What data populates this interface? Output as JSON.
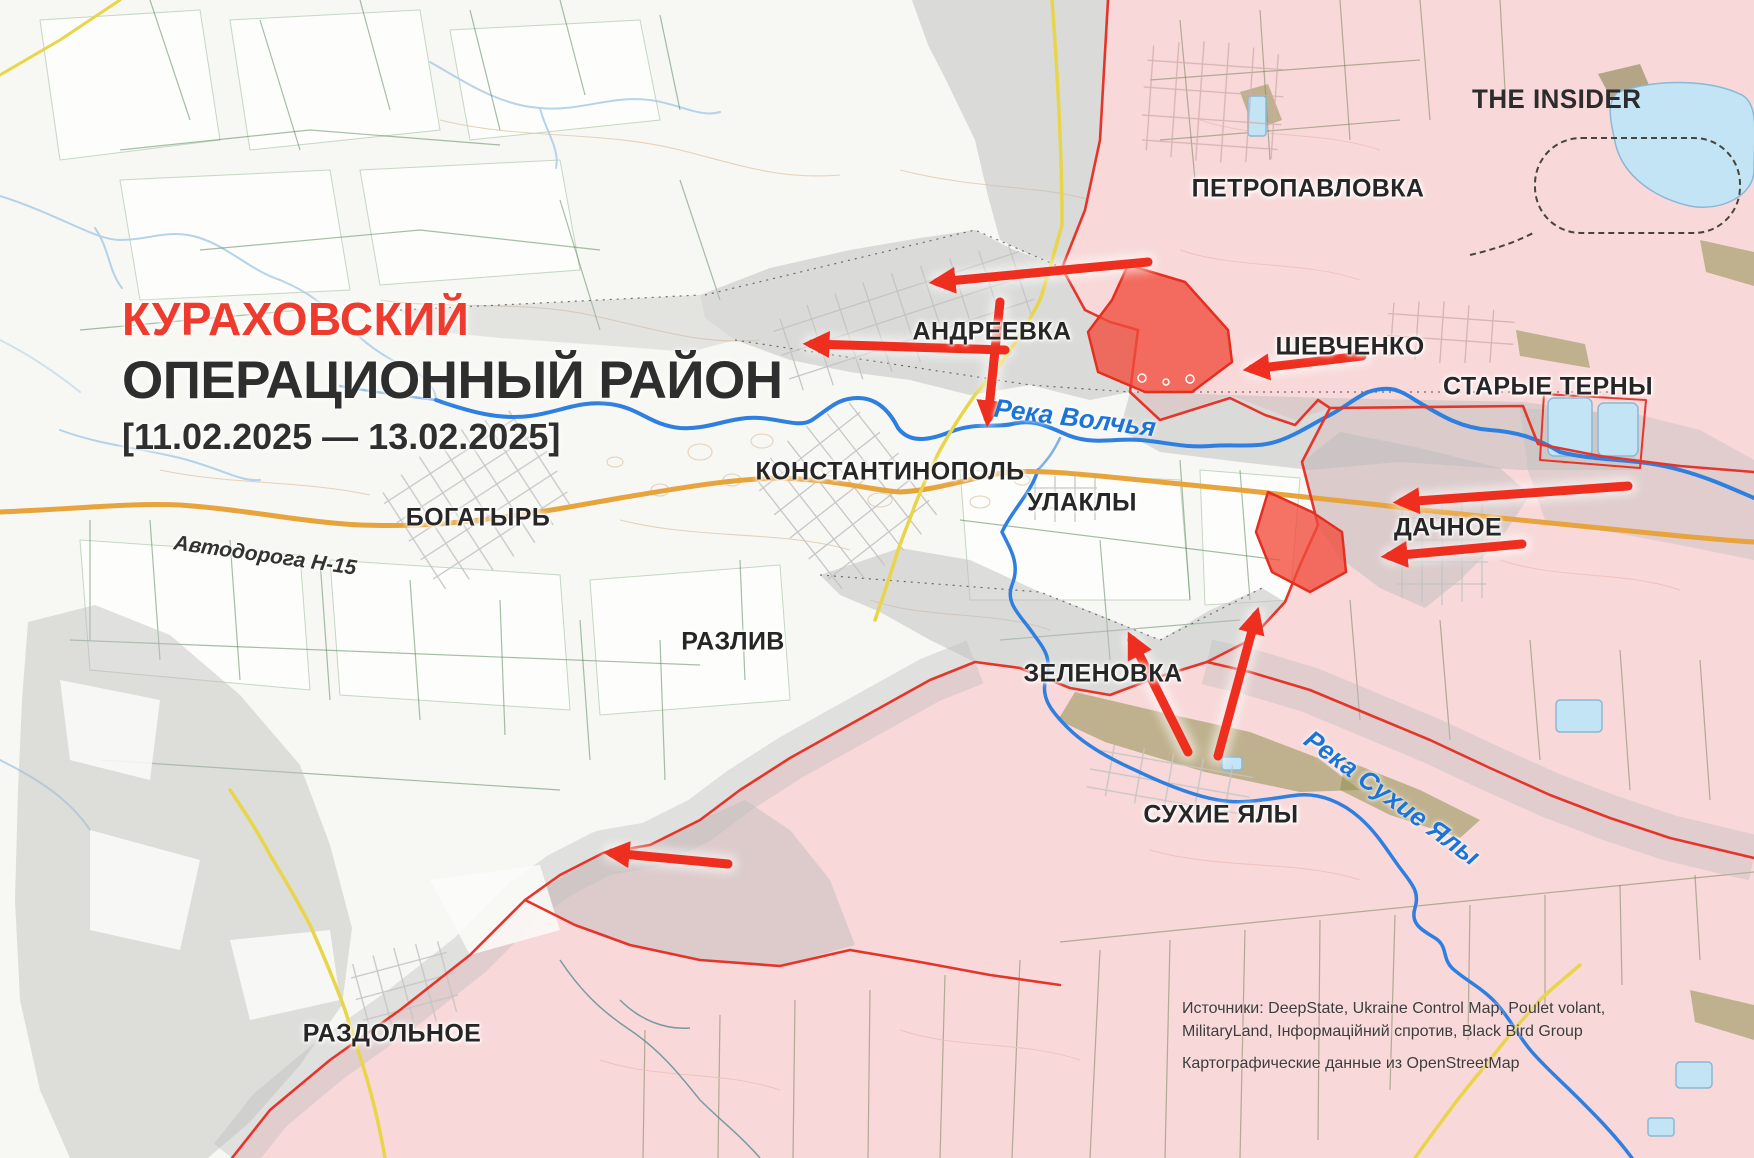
{
  "brand": {
    "logo_text": "THE INSIDER"
  },
  "title": {
    "region": "КУРАХОВСКИЙ",
    "subtitle": "ОПЕРАЦИОННЫЙ РАЙОН",
    "period": "[11.02.2025 — 13.02.2025]"
  },
  "settlements": [
    {
      "id": "petropavlovka",
      "name": "ПЕТРОПАВЛОВКА"
    },
    {
      "id": "andreevka",
      "name": "АНДРЕЕВКА"
    },
    {
      "id": "shevchenko",
      "name": "ШЕВЧЕНКО"
    },
    {
      "id": "staryye-terny",
      "name": "СТАРЫЕ ТЕРНЫ"
    },
    {
      "id": "konstantinopol",
      "name": "КОНСТАНТИНОПОЛЬ"
    },
    {
      "id": "ulakly",
      "name": "УЛАКЛЫ"
    },
    {
      "id": "dachnoye",
      "name": "ДАЧНОЕ"
    },
    {
      "id": "bogatyr",
      "name": "БОГАТЫРЬ"
    },
    {
      "id": "razliv",
      "name": "РАЗЛИВ"
    },
    {
      "id": "zelenovka",
      "name": "ЗЕЛЕНОВКА"
    },
    {
      "id": "sukhiye-yaly",
      "name": "СУХИЕ ЯЛЫ"
    },
    {
      "id": "razdolnoye",
      "name": "РАЗДОЛЬНОЕ"
    }
  ],
  "water_labels": [
    {
      "id": "volchya",
      "name": "Река Волчья"
    },
    {
      "id": "sukhiye-yaly",
      "name": "Река Сухие Ялы"
    }
  ],
  "road_labels": [
    {
      "id": "h15",
      "name": "Автодорога Н-15"
    }
  ],
  "attribution": {
    "sources_line1": "Источники: DeepState, Ukraine Control Map, Poulet volant,",
    "sources_line2": "MilitaryLand, Інформаційний спротив, Black Bird Group",
    "cartography": "Картографические данные из OpenStreetMap"
  },
  "map_semantics": {
    "pink_zone": "Occupied / Russian-controlled area",
    "gray_zone": "Contested gray zone",
    "red_fill": "Recent Russian advance",
    "red_arrows": "Russian attack directions",
    "colors": {
      "pink_zone": "#f8d8d8",
      "gray_zone": "#bdbdbd",
      "advance_red": "#f14b3b",
      "front_line": "#e5352a",
      "river_blue": "#2e7fe0",
      "road_orange": "#e7a33c",
      "road_yellow": "#e8d54a",
      "title_red": "#ef3b2e",
      "text_dark": "#2e2e2e"
    }
  }
}
